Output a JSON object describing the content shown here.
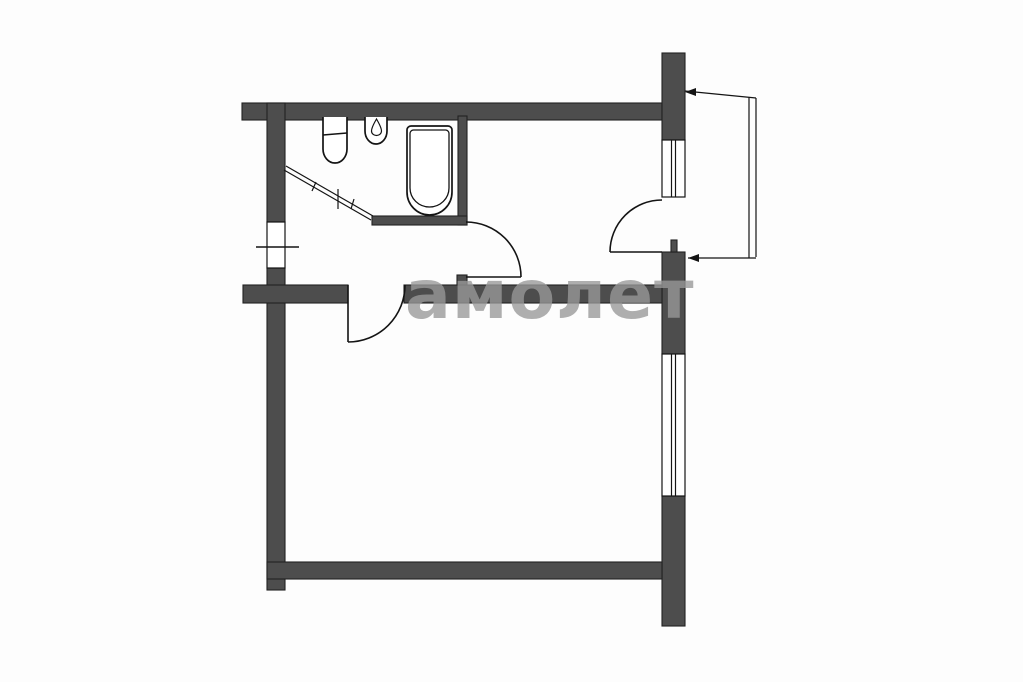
{
  "watermark": {
    "text": "амолет"
  },
  "colors": {
    "background": "#fdfdfd",
    "wall_fill": "#4d4d4d",
    "wall_stroke": "#222222",
    "line": "#141414",
    "watermark": "#999999"
  },
  "plan": {
    "type": "apartment-floor-plan",
    "rooms": [
      "bathroom",
      "hallway",
      "kitchen-area",
      "living-room",
      "balcony"
    ],
    "fixtures": [
      "toilet",
      "sink",
      "bathtub"
    ],
    "doors": [
      "hall-door",
      "living-room-door",
      "balcony-door",
      "entry-opening"
    ],
    "windows": [
      "upper-window",
      "lower-window"
    ]
  }
}
